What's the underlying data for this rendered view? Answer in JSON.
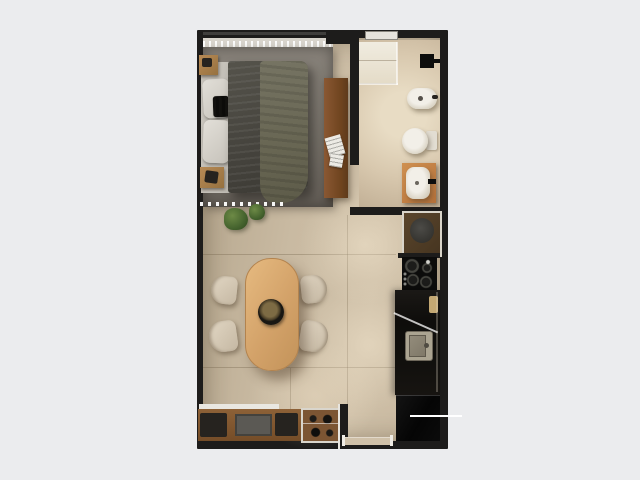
{
  "scene": {
    "title": "Studio apartment floor plan – top-down 3D render",
    "view": "top-down",
    "text_visible": "none"
  },
  "colors": {
    "background": "#ebecee",
    "wall": "#1d1c1b",
    "floor": "#c9baa2",
    "floor-light": "#e6d8bf",
    "bathroom-floor": "#dbcbb1",
    "rug": "#7c766e",
    "duvet": "#49473f",
    "blanket": "#6e6c5a",
    "pillow": "#dcd9d1",
    "wood-light": "#d7a873",
    "wood-mid": "#a87c4b",
    "wood-dark": "#7c5531",
    "vanity-wood": "#c28146",
    "chair": "#d7cab7",
    "white-fixture": "#ece8e0",
    "counter": "#12100e",
    "appliance-black": "#070707",
    "steel": "#aba491",
    "plant-green": "#4c6c33",
    "accent-white": "#ffffff"
  },
  "rooms": {
    "bedroom": {
      "label": "sleeping area",
      "items": [
        "area-rug",
        "double-bed",
        "pillows",
        "knit-cushion",
        "nightstand-upper",
        "nightstand-lower",
        "window-curtain",
        "sideboard-desk",
        "potted-plants"
      ]
    },
    "bathroom": {
      "label": "bathroom",
      "items": [
        "shower",
        "shower-fixture",
        "bidet",
        "toilet",
        "washbasin-vanity",
        "bathroom-window"
      ]
    },
    "kitchen": {
      "label": "kitchen strip",
      "items": [
        "washing-machine",
        "cooktop",
        "countertop",
        "kitchen-sink",
        "refrigerator"
      ]
    },
    "dining": {
      "label": "dining area",
      "items": [
        "dining-table",
        "centerpiece-bowl"
      ],
      "chair_count": 4
    },
    "living": {
      "label": "media wall",
      "items": [
        "media-console",
        "tv",
        "display-case"
      ]
    },
    "entry": {
      "label": "entrance",
      "items": [
        "door-threshold"
      ]
    }
  },
  "annotation": {
    "leader_line": "white callout line pointing to refrigerator"
  }
}
